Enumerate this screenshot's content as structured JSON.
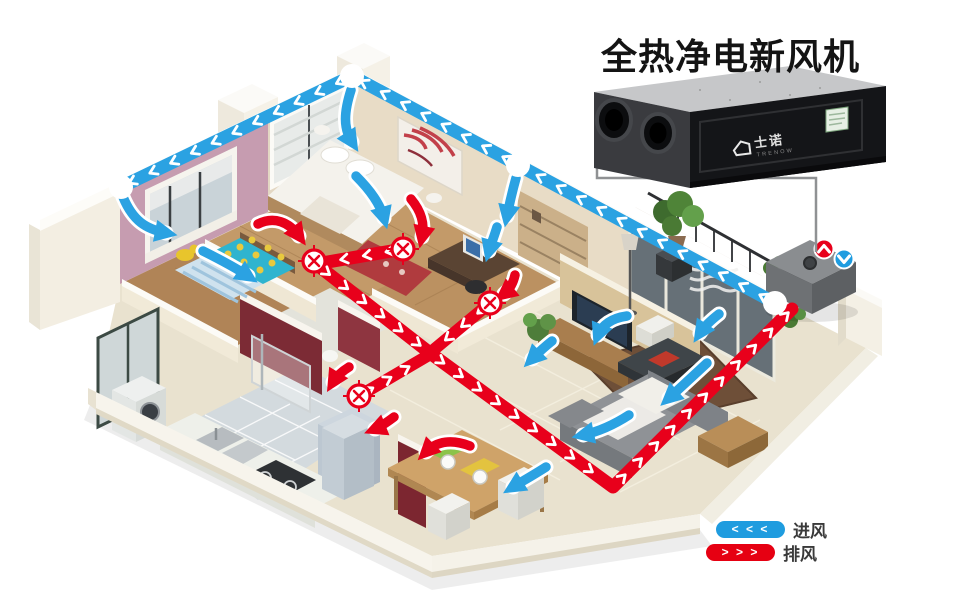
{
  "title": "全热净电新风机",
  "product": {
    "brand": "士诺",
    "brand_sub": "TRENOW"
  },
  "legend": {
    "items": [
      {
        "label": "进风",
        "glyphs": "< < <",
        "color": "#1f9cdf"
      },
      {
        "label": "排风",
        "glyphs": "> > >",
        "color": "#e60012"
      }
    ]
  },
  "colors": {
    "supply": "#2ba2e2",
    "exhaust": "#e8001b",
    "title_color": "#141414"
  },
  "scene": {
    "ducts": [
      {
        "id": "supply-duct",
        "type": "supply",
        "width": 13,
        "spacing": 23,
        "points": [
          [
            775,
            303
          ],
          [
            518,
            165
          ],
          [
            352,
            76
          ],
          [
            121,
            187
          ]
        ]
      },
      {
        "id": "exhaust-duct-main",
        "type": "exhaust",
        "width": 13,
        "spacing": 23,
        "points": [
          [
            403,
            249
          ],
          [
            316,
            264
          ],
          [
            430,
            353
          ],
          [
            613,
            487
          ],
          [
            792,
            309
          ]
        ]
      },
      {
        "id": "exhaust-branch-study",
        "type": "exhaust",
        "width": 12,
        "spacing": 21,
        "points": [
          [
            490,
            303
          ],
          [
            431,
            352
          ]
        ]
      },
      {
        "id": "exhaust-branch-hall",
        "type": "exhaust",
        "width": 12,
        "spacing": 21,
        "points": [
          [
            359,
            396
          ],
          [
            429,
            355
          ]
        ]
      }
    ],
    "supply_vents": [
      [
        775,
        303
      ],
      [
        518,
        165
      ],
      [
        352,
        76
      ],
      [
        121,
        187
      ]
    ],
    "exhaust_vents": [
      [
        403,
        249
      ],
      [
        314,
        261
      ],
      [
        490,
        303
      ],
      [
        359,
        396
      ]
    ],
    "arrows": [
      {
        "type": "supply",
        "d": "M123,197 C133,221 146,229 166,233"
      },
      {
        "type": "supply",
        "d": "M203,251 C223,261 236,268 248,276"
      },
      {
        "type": "supply",
        "d": "M351,90 C344,112 343,128 352,142"
      },
      {
        "type": "supply",
        "d": "M356,176 C371,191 380,204 384,218"
      },
      {
        "type": "supply",
        "d": "M516,178 C511,196 509,206 507,216"
      },
      {
        "type": "supply",
        "d": "M497,227 C494,237 491,244 489,251"
      },
      {
        "type": "supply",
        "d": "M627,316 C612,318 602,325 598,335"
      },
      {
        "type": "supply",
        "d": "M719,314 C710,321 704,327 700,333"
      },
      {
        "type": "supply",
        "d": "M707,363 C692,377 679,389 669,398"
      },
      {
        "type": "supply",
        "d": "M629,415 C612,426 597,432 583,435"
      },
      {
        "type": "supply",
        "d": "M546,467 C532,476 521,482 513,487"
      },
      {
        "type": "supply",
        "d": "M552,341 C543,348 537,354 532,359"
      },
      {
        "type": "exhaust",
        "d": "M258,224 C274,216 289,222 299,236"
      },
      {
        "type": "exhaust",
        "d": "M411,199 C421,211 425,223 422,237"
      },
      {
        "type": "exhaust",
        "d": "M515,275 C513,284 509,290 504,294"
      },
      {
        "type": "exhaust",
        "d": "M349,367 C341,372 336,377 333,382"
      },
      {
        "type": "exhaust",
        "d": "M394,417 C386,423 380,427 375,429"
      },
      {
        "type": "exhaust",
        "d": "M470,446 C452,439 437,441 426,452"
      }
    ]
  }
}
